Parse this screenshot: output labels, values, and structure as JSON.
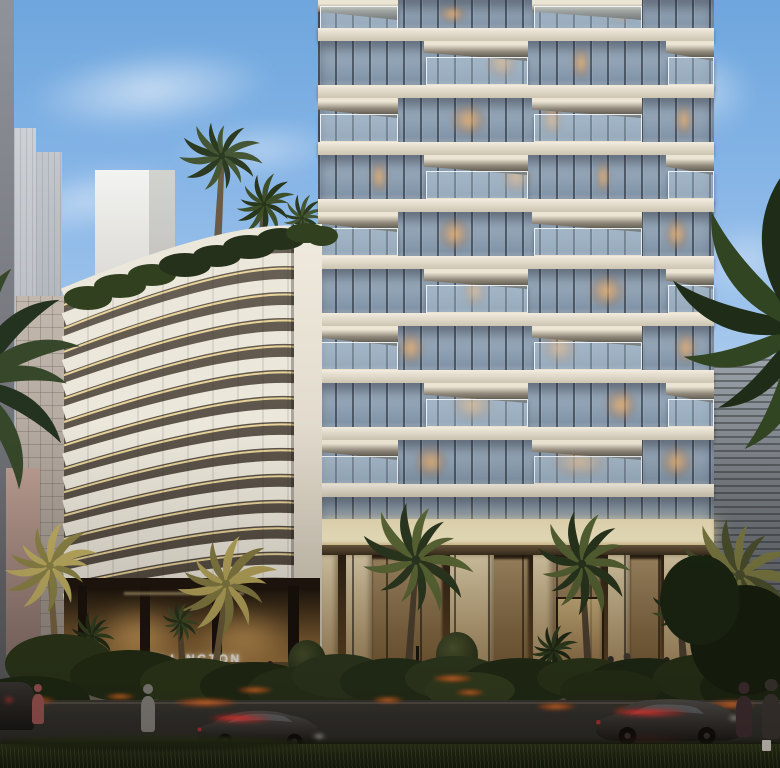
{
  "scene": {
    "type": "architectural-dusk-rendering",
    "description": "Ellington residential development at dusk: curved louvered mid-rise with gold-lit bands beside a white-slab glass balcony tower, palm-lined street, lit lobby, cars with red light trails and pedestrians",
    "sign_text": "ELLINGTON"
  },
  "palette": {
    "sky_top": "#6ea6dd",
    "sky_mid": "#9fc4ec",
    "sky_low": "#cfd8e2",
    "horizon_pink": "#d8c2b6",
    "slab": "#efe9dc",
    "glass": "#8fa3b6",
    "mullion": "#2a3140",
    "warm_window": "#eab068",
    "band_white": "#ece7db",
    "band_gold": "#ffe9a8",
    "band_gap": "#5e564a",
    "bronze_wall": "#a87c42",
    "lobby_glow": "#d8b070",
    "canopy_glow": "#fdf4cf",
    "road": "#32312d",
    "grass": "#1e2614",
    "hedge": "#26331a",
    "flower_orange": "#ff7a2e",
    "taillight_red": "#ff4040",
    "palm_dark": "#2a3820",
    "palm_gold": "#b8a75c",
    "stone_pier": "#d5c49d"
  },
  "tower": {
    "x": 318,
    "width": 396,
    "first_slab_y": 28,
    "pitch": 57,
    "slab_h": 13,
    "floors": 9,
    "podium_glass_y": 497,
    "canopy_y": 519,
    "canopy_h": 26,
    "lobby_y": 545,
    "lobby_h": 163,
    "balcony_patterns": [
      [
        [
          0,
          80
        ],
        [
          214,
          110
        ]
      ],
      [
        [
          106,
          104
        ],
        [
          348,
          48
        ]
      ]
    ],
    "lit_windows": [
      [
        0,
        0.3,
        0.08
      ],
      [
        0,
        0.74,
        0.05
      ],
      [
        1,
        0.42,
        0.09
      ],
      [
        1,
        0.64,
        0.05
      ],
      [
        2,
        0.33,
        0.1
      ],
      [
        2,
        0.56,
        0.06
      ],
      [
        2,
        0.9,
        0.05
      ],
      [
        3,
        0.13,
        0.05
      ],
      [
        3,
        0.46,
        0.08
      ],
      [
        3,
        0.7,
        0.04
      ],
      [
        4,
        0.3,
        0.09
      ],
      [
        4,
        0.87,
        0.07
      ],
      [
        5,
        0.36,
        0.07
      ],
      [
        5,
        0.68,
        0.1
      ],
      [
        6,
        0.2,
        0.07
      ],
      [
        6,
        0.56,
        0.1
      ],
      [
        6,
        0.9,
        0.06
      ],
      [
        7,
        0.33,
        0.12
      ],
      [
        7,
        0.72,
        0.09
      ],
      [
        8,
        0.24,
        0.09
      ],
      [
        8,
        0.58,
        0.16
      ],
      [
        8,
        0.86,
        0.09
      ]
    ],
    "piers": [
      [
        322,
        16
      ],
      [
        346,
        26
      ],
      [
        450,
        44
      ],
      [
        533,
        20
      ],
      [
        608,
        22
      ],
      [
        664,
        40
      ]
    ],
    "warm_zones": [
      [
        372,
        70
      ],
      [
        470,
        58
      ],
      [
        548,
        52
      ],
      [
        630,
        30
      ],
      [
        700,
        12
      ]
    ]
  },
  "curved_building": {
    "x": 58,
    "y": 220,
    "w": 264,
    "h": 448,
    "bands": 14,
    "pitch": 26,
    "right_col_x": 236,
    "note": "white louver arcs with gold underlight, dark gaps"
  },
  "bg_buildings": [
    {
      "name": "left-edge-strip",
      "x": 0,
      "y": 0,
      "w": 14,
      "h": 712,
      "c1": "#90929a",
      "c2": "#5c5d62"
    },
    {
      "name": "pale-tower-1",
      "x": 14,
      "y": 128,
      "w": 22,
      "h": 320,
      "c1": "#cdd1d6",
      "c2": "#aeb3ba"
    },
    {
      "name": "pale-tower-2",
      "x": 36,
      "y": 152,
      "w": 26,
      "h": 300,
      "c1": "#c2c7cd",
      "c2": "#a3a8b0"
    },
    {
      "name": "white-box-building",
      "x": 95,
      "y": 170,
      "w": 80,
      "h": 130,
      "c1": "#f3f3f1",
      "c2": "#d7d6d2"
    },
    {
      "name": "grid-facade-building",
      "x": 16,
      "y": 296,
      "w": 94,
      "h": 344,
      "c1": "#c3b8ae",
      "c2": "#9d948c"
    },
    {
      "name": "pink-sliver",
      "x": 6,
      "y": 468,
      "w": 34,
      "h": 196,
      "c1": "#bb9d92",
      "c2": "#8d7670"
    },
    {
      "name": "right-slate-building",
      "x": 714,
      "y": 356,
      "w": 66,
      "h": 348,
      "c1": "#9aa1a8",
      "c2": "#565b60"
    }
  ],
  "clouds": [
    [
      150,
      90,
      340,
      110,
      -6,
      0.65
    ],
    [
      90,
      200,
      260,
      90,
      -12,
      0.5
    ],
    [
      260,
      150,
      240,
      80,
      -4,
      0.45
    ],
    [
      60,
      330,
      220,
      80,
      -8,
      0.4
    ],
    [
      40,
      470,
      200,
      70,
      -4,
      0.35
    ],
    [
      700,
      90,
      150,
      120,
      12,
      0.5
    ],
    [
      745,
      260,
      110,
      160,
      85,
      0.4
    ],
    [
      735,
      420,
      100,
      120,
      80,
      0.3
    ]
  ],
  "palms_back": [
    {
      "cx": 222,
      "cy": 156,
      "r": 42,
      "c1": "#2c3a21",
      "c2": "#445633",
      "trunk": [
        217,
        255
      ],
      "tc": "#6b5b44"
    },
    {
      "cx": 264,
      "cy": 204,
      "r": 32,
      "c1": "#283619",
      "c2": "#3d4f2a",
      "trunk": [
        260,
        258
      ],
      "tc": "#5f5140"
    },
    {
      "cx": 302,
      "cy": 218,
      "r": 24,
      "c1": "#2c3a21",
      "c2": "#445633",
      "trunk": [
        300,
        252
      ],
      "tc": "#5f5140"
    }
  ],
  "palms_mid": [
    {
      "cx": -28,
      "cy": 382,
      "r": 118,
      "c1": "#243220",
      "c2": "#37482a",
      "trunk": null
    },
    {
      "cx": 802,
      "cy": 330,
      "r": 150,
      "c1": "#1f2d18",
      "c2": "#324522",
      "trunk": null
    },
    {
      "cx": 740,
      "cy": 575,
      "r": 62,
      "c1": "#4a4e2c",
      "c2": "#7c7a42",
      "trunk": [
        742,
        660
      ],
      "tc": "#4e4130"
    },
    {
      "cx": 50,
      "cy": 566,
      "r": 48,
      "c1": "#8f8747",
      "c2": "#c2b264",
      "trunk": [
        58,
        688
      ],
      "tc": "#7a6742"
    },
    {
      "cx": 226,
      "cy": 584,
      "r": 52,
      "c1": "#857c42",
      "c2": "#b8a75c",
      "trunk": [
        210,
        708
      ],
      "tc": "#6e5c3a"
    },
    {
      "cx": 416,
      "cy": 560,
      "r": 58,
      "c1": "#2a3820",
      "c2": "#5c6a36",
      "trunk": [
        406,
        700
      ],
      "tc": "#4e4130"
    },
    {
      "cx": 582,
      "cy": 564,
      "r": 52,
      "c1": "#27351d",
      "c2": "#566434",
      "trunk": [
        590,
        698
      ],
      "tc": "#4e4130"
    },
    {
      "cx": 680,
      "cy": 610,
      "r": 30,
      "c1": "#22301a",
      "c2": "#3a4c26",
      "trunk": [
        684,
        668
      ],
      "tc": "#4e4130"
    },
    {
      "cx": 553,
      "cy": 650,
      "r": 26,
      "c1": "#1c2813",
      "c2": "#2e3d1d",
      "trunk": null
    },
    {
      "cx": 92,
      "cy": 636,
      "r": 24,
      "c1": "#202c15",
      "c2": "#32401f",
      "trunk": null
    },
    {
      "cx": 180,
      "cy": 622,
      "r": 20,
      "c1": "#25311a",
      "c2": "#3a4a24",
      "trunk": [
        184,
        694
      ],
      "tc": "#5a4a32"
    }
  ],
  "rooftop_hedge": [
    [
      88,
      298,
      24,
      12
    ],
    [
      120,
      286,
      26,
      12
    ],
    [
      152,
      275,
      24,
      11
    ],
    [
      185,
      265,
      26,
      12
    ],
    [
      217,
      256,
      24,
      11
    ],
    [
      249,
      247,
      26,
      12
    ],
    [
      281,
      239,
      24,
      11
    ],
    [
      306,
      233,
      20,
      10
    ],
    [
      322,
      236,
      16,
      10
    ]
  ],
  "hedges": [
    [
      60,
      664,
      55,
      30,
      "#2a3719"
    ],
    [
      130,
      676,
      60,
      26,
      "#202d14"
    ],
    [
      195,
      682,
      55,
      24,
      "#2b3818"
    ],
    [
      255,
      686,
      55,
      24,
      "#1e2a13"
    ],
    [
      305,
      690,
      58,
      24,
      "#27341a"
    ],
    [
      30,
      700,
      60,
      24,
      "#1c2812"
    ],
    [
      340,
      676,
      48,
      22,
      "#2c381e"
    ],
    [
      395,
      682,
      55,
      24,
      "#223017"
    ],
    [
      455,
      678,
      50,
      22,
      "#2e3b1f"
    ],
    [
      520,
      682,
      58,
      24,
      "#1f2c15"
    ],
    [
      585,
      678,
      48,
      20,
      "#293618"
    ],
    [
      645,
      684,
      60,
      26,
      "#1b2813"
    ],
    [
      705,
      678,
      52,
      24,
      "#253217"
    ],
    [
      755,
      688,
      55,
      28,
      "#1a2611"
    ],
    [
      470,
      690,
      45,
      18,
      "#33411f"
    ],
    [
      610,
      690,
      50,
      20,
      "#242f16"
    ],
    [
      745,
      640,
      55,
      55,
      "#131d0c"
    ],
    [
      700,
      600,
      40,
      45,
      "#182410"
    ]
  ],
  "flowers": [
    [
      30,
      700,
      70,
      13
    ],
    [
      120,
      696,
      40,
      9
    ],
    [
      205,
      702,
      85,
      13
    ],
    [
      255,
      690,
      48,
      10
    ],
    [
      388,
      700,
      42,
      10
    ],
    [
      452,
      678,
      55,
      11
    ],
    [
      470,
      692,
      40,
      9
    ],
    [
      556,
      706,
      54,
      11
    ],
    [
      648,
      710,
      95,
      15
    ],
    [
      732,
      704,
      62,
      13
    ]
  ],
  "people_back": [
    [
      368,
      698,
      30,
      "#2b2622"
    ],
    [
      402,
      698,
      28,
      "#332c26"
    ],
    [
      433,
      699,
      31,
      "#c06a2a"
    ],
    [
      452,
      697,
      26,
      "#2e2925"
    ],
    [
      470,
      697,
      26,
      "#3a332c"
    ],
    [
      492,
      698,
      24,
      "#2a2520"
    ],
    [
      507,
      699,
      28,
      "#3f352c"
    ],
    [
      560,
      696,
      30,
      "#2c2723"
    ],
    [
      584,
      695,
      28,
      "#37302a"
    ],
    [
      611,
      694,
      30,
      "#2e2a26"
    ],
    [
      627,
      693,
      32,
      "#463c30"
    ],
    [
      667,
      695,
      30,
      "#2b2623"
    ],
    [
      687,
      694,
      28,
      "#3a322b"
    ],
    [
      711,
      695,
      30,
      "#2d2824"
    ],
    [
      244,
      698,
      26,
      "#33291f"
    ],
    [
      270,
      696,
      28,
      "#27221e"
    ],
    [
      175,
      700,
      30,
      "#cfc6b8"
    ],
    [
      208,
      700,
      30,
      "#3a3026"
    ]
  ],
  "people_front": [
    [
      38,
      732,
      38,
      "#a85a58"
    ],
    [
      148,
      742,
      46,
      "#8f8d89"
    ],
    [
      744,
      748,
      52,
      "#402e33"
    ],
    [
      771,
      752,
      58,
      "#3b3633"
    ]
  ],
  "cars": {
    "sedan": {
      "x": 194,
      "y": 700,
      "w": 128,
      "h": 48,
      "trail": [
        198,
        712,
        86,
        13
      ],
      "headlight": [
        310,
        732,
        18,
        9
      ]
    },
    "suv": {
      "x": 592,
      "y": 688,
      "w": 146,
      "h": 56,
      "trail": [
        598,
        706,
        104,
        13
      ],
      "headlight": [
        726,
        714,
        16,
        8
      ]
    },
    "left_partial": {
      "x": -18,
      "y": 682,
      "w": 52,
      "h": 48,
      "lights": [
        [
          4,
          698
        ],
        [
          20,
          696
        ]
      ]
    },
    "parked": {
      "x": 168,
      "y": 676,
      "w": 104,
      "h": 30
    }
  }
}
